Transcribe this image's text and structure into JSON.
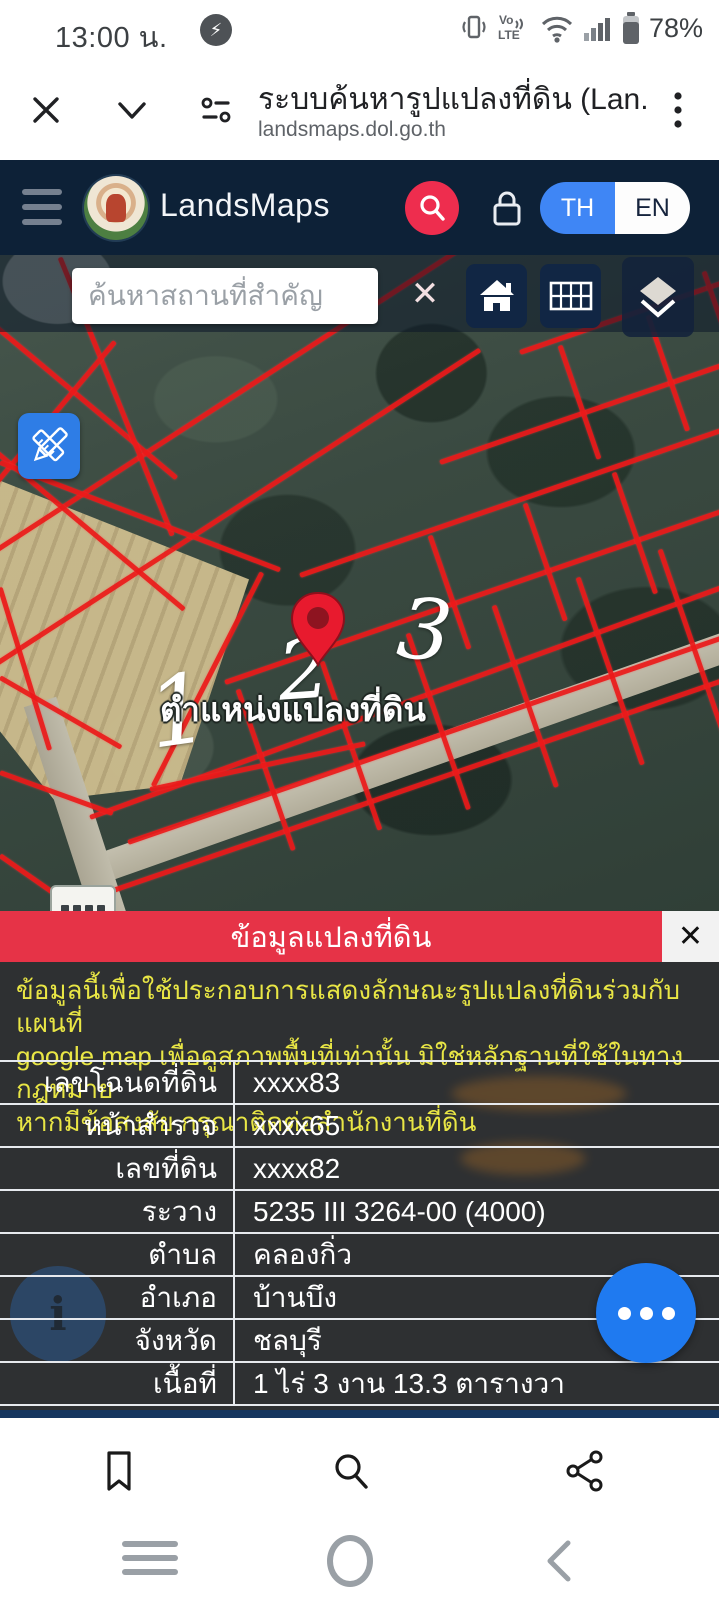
{
  "status_bar": {
    "time": "13:00 น.",
    "battery_percent": "78%"
  },
  "browser": {
    "page_title": "ระบบค้นหารูปแปลงที่ดิน (Lan...",
    "url": "landsmaps.dol.go.th"
  },
  "app_header": {
    "app_name": "LandsMaps",
    "language_toggle": {
      "th": "TH",
      "en": "EN"
    }
  },
  "map": {
    "search_placeholder": "ค้นหาสถานที่สำคัญ",
    "clear_label": "✕",
    "pin_label": "ตำแหน่งแปลงที่ดิน",
    "parcel_numbers": [
      "1",
      "2",
      "3"
    ]
  },
  "panel": {
    "title": "ข้อมูลแปลงที่ดิน",
    "close_label": "✕",
    "disclaimer_lines": [
      "ข้อมูลนี้เพื่อใช้ประกอบการแสดงลักษณะรูปแปลงที่ดินร่วมกับแผนที่",
      "google map เพื่อดูสภาพพื้นที่เท่านั้น มิใช่หลักฐานที่ใช้ในทางกฎหมาย",
      "หากมีข้อสงสัย กรุณาติดต่อสำนักงานที่ดิน"
    ],
    "rows": [
      {
        "label": "เลขโฉนดที่ดิน",
        "value": "xxxx83"
      },
      {
        "label": "หน้าสำรวจ",
        "value": "xxxx65"
      },
      {
        "label": "เลขที่ดิน",
        "value": "xxxx82"
      },
      {
        "label": "ระวาง",
        "value": "5235 III 3264-00 (4000)"
      },
      {
        "label": "ตำบล",
        "value": "คลองกิ่ว"
      },
      {
        "label": "อำเภอ",
        "value": "บ้านบึง"
      },
      {
        "label": "จังหวัด",
        "value": "ชลบุรี"
      },
      {
        "label": "เนื้อที่",
        "value": "1 ไร่ 3 งาน 13.3 ตารางวา"
      }
    ]
  },
  "colors": {
    "header_navy": "#0d2137",
    "accent_red": "#e63347",
    "parcel_line_red": "#ec1a1a",
    "toggle_blue": "#3f86f5",
    "fab_blue": "#1f7af0",
    "disclaimer_yellow": "#e9e645"
  }
}
